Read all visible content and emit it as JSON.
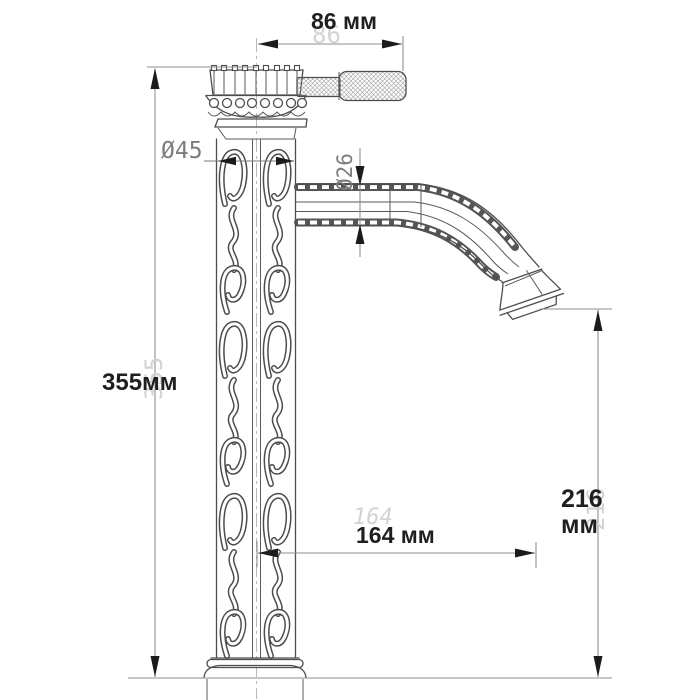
{
  "drawing": {
    "subject": "ornate single-handle vessel faucet, dimensioned technical drawing",
    "units": "мм",
    "dimensions": {
      "width": {
        "label": "86 мм",
        "ghost": "86",
        "meaning": "overall width from column centerline to handle end"
      },
      "height": {
        "label": "355мм",
        "ghost": "355",
        "meaning": "overall height"
      },
      "column_diameter": {
        "label": "Ø45",
        "meaning": "column body diameter"
      },
      "spout_diameter": {
        "label": "Ø26",
        "meaning": "spout pipe diameter"
      },
      "spout_height": {
        "value": "216",
        "unit": "мм",
        "ghost": "216",
        "meaning": "spout outlet height above base"
      },
      "spout_reach": {
        "label": "164 мм",
        "ghost": "164",
        "meaning": "spout reach from column centerline"
      }
    },
    "colors": {
      "background": "#ffffff",
      "outline": "#4d4d4d",
      "dimension_line": "#8f8f8f",
      "arrow": "#1c1c1c",
      "bold_text": "#1f1f1f",
      "ghost_text": "#d3d3d3",
      "cad_text": "#7c7c7c"
    }
  }
}
